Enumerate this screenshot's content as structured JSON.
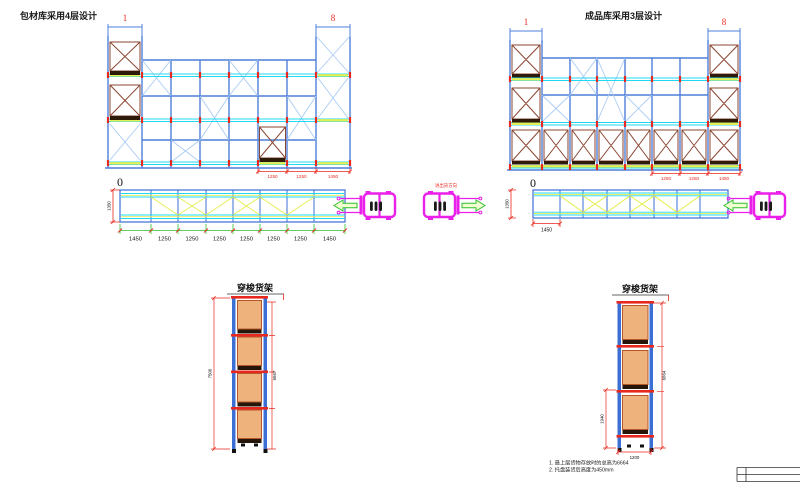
{
  "drawing": {
    "left": {
      "title": "包材库采用4层设计",
      "frame_first": "1",
      "frame_last": "8",
      "origin_label": "0",
      "elevation_dims": [
        "1250",
        "1250",
        "1450"
      ],
      "plan_depth_dim": "1350",
      "plan_bay_dims": [
        "1450",
        "1250",
        "1250",
        "1250",
        "1250",
        "1250",
        "1250",
        "1450"
      ]
    },
    "right": {
      "title": "成品库采用3层设计",
      "frame_first": "1",
      "frame_last": "8",
      "origin_label": "0",
      "elevation_dims": [
        "1250",
        "1250",
        "1450"
      ],
      "plan_depth_dim": "1350",
      "plan_first_bay_dim": "1450"
    },
    "traffic_direction_label": "进出货方向",
    "shuttle_left": {
      "title": "穿梭货架",
      "height_dim_outer": "7500",
      "height_dim_inner": "6667"
    },
    "shuttle_right": {
      "title": "穿梭货架",
      "height_dim_outer": "6664",
      "height_dim_lower": "1940",
      "width_dim": "1200"
    },
    "notes": [
      "1.  最上层货物存放时的总高为6664",
      "2.  托盘装货后高度为450mm"
    ],
    "colors": {
      "column_blue": "#4f7fd9",
      "light_blue_brace": "#a9ccf4",
      "rail_cyan": "#21d8f2",
      "pallet_frame_brown": "#8a4632",
      "highlight_yellow": "#e6ee53",
      "dimension_red": "#e8281e",
      "dimension_green": "#2fbf2f",
      "forklift_magenta": "#ea1fea",
      "load_box_orange": "#eeb27c"
    }
  }
}
